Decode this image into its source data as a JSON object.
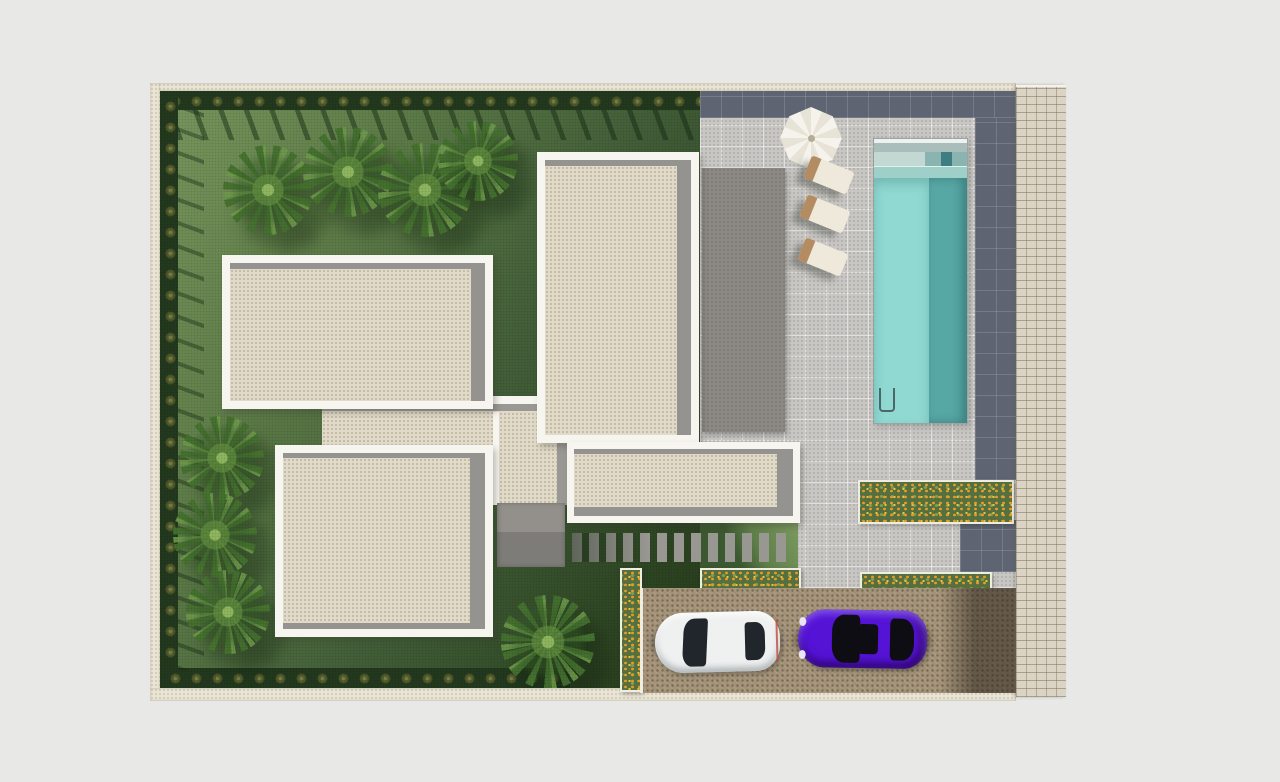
{
  "scene": {
    "description": "Aerial top-down 3D architectural render: site plan of a modern villa plot with lawn garden and boundary hedges, palm trees, four flat cream roof volumes with white parapets, gray terrace canopy, rectangular swimming pool with entry steps and ladder, white octagonal parasol with three sun loungers, orange flower planters, paver stepping-stone path, cobblestone parking court with a white coupe and a purple sedan, and a cobble walkway along the right boundary",
    "canvas_width": 1280,
    "canvas_height": 782
  },
  "palette": {
    "page_background": "#e8e8e7",
    "plot_wall": "#e9e4d4",
    "grass_light": "#7c9a60",
    "grass_dark": "#2a411f",
    "hedge": "#233a1e",
    "shrub": "#7c7e44",
    "palm_leaf": "#6b9a4a",
    "roof_cream": "#e1dac8",
    "roof_parapet": "#f7f5ef",
    "roof_shadow_band": "#95938f",
    "terrace_roof_gray": "#8c8883",
    "paver_light": "#c9c7c3",
    "slate_border": "#5e6472",
    "pool_water_light": "#8fd9d2",
    "pool_water_deep": "#57a7a5",
    "pool_step": "#9ed0c9",
    "cobble_path": "#dbd3c4",
    "driveway_cobble": "#a29176",
    "flower_green": "#55703e",
    "flower_orange": "#e69a28",
    "flower_yellow": "#f2c23e",
    "car_white": "#eff1f1",
    "car_purple": "#5513d6",
    "umbrella": "#f3f0e8",
    "lounger": "#efe9dc",
    "patio_gray": "#8f8d89"
  },
  "objects": {
    "garden": {
      "label": "lawn with clipped shrub hedges on left, top and bottom boundaries"
    },
    "palm_trees": {
      "count": 8,
      "placement": "four along the top lawn, three on the lower-left lawn, one at bottom centre"
    },
    "villa_roofs": {
      "count": 4,
      "label": "cream flat roofs with white parapets and gray shadow bands"
    },
    "roof_connectors": {
      "count": 2
    },
    "terrace_canopy": {
      "label": "gray canopy roof beside the tall central volume"
    },
    "pool": {
      "label": "rectangular pool, light shallow side and deep teal side, entry steps at top, ladder at bottom-left"
    },
    "parasol": {
      "label": "white octagonal parasol"
    },
    "sun_loungers": {
      "count": 3,
      "label": "cream loungers stepped diagonally with wooden headrests"
    },
    "flower_beds": {
      "count": 4,
      "label": "white-edged planters with orange and yellow flowers"
    },
    "stepping_stones": {
      "label": "gray paver slats across the lawn"
    },
    "patio": {
      "label": "small gray patio between roof volumes"
    },
    "driveway": {
      "label": "brown cobblestone parking court with white curbs"
    },
    "cars": [
      {
        "label": "white coupe, parked facing left",
        "color": "#eff1f1"
      },
      {
        "label": "purple sedan, parked facing left",
        "color": "#5513d6"
      }
    ],
    "walkway": {
      "label": "light cobble strip along the right plot boundary"
    }
  }
}
